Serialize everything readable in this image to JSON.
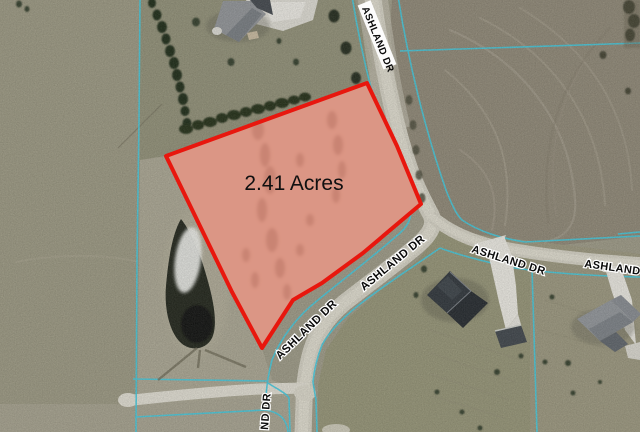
{
  "map": {
    "type": "aerial-parcel-map",
    "parcel": {
      "area_label": "2.41 Acres",
      "area_acres": 2.41,
      "outline_color": "#e8170e",
      "fill_color": "#f98b7b"
    },
    "road_name": "ASHLAND DR",
    "labels": {
      "road_top": "ASHLAND DR",
      "road_sw_upper": "ASHLAND DR",
      "road_sw_lower": "ASHLAND DR",
      "road_east_mid": "ASHLAND DR",
      "road_east_right": "ASHLAND DR",
      "road_south_partial": "ND DR"
    },
    "colors": {
      "boundary_line": "#3fc8de",
      "road_surface": "#d5d2c6",
      "field_plowed": "#8d8675",
      "field_pasture": "#999680"
    }
  }
}
